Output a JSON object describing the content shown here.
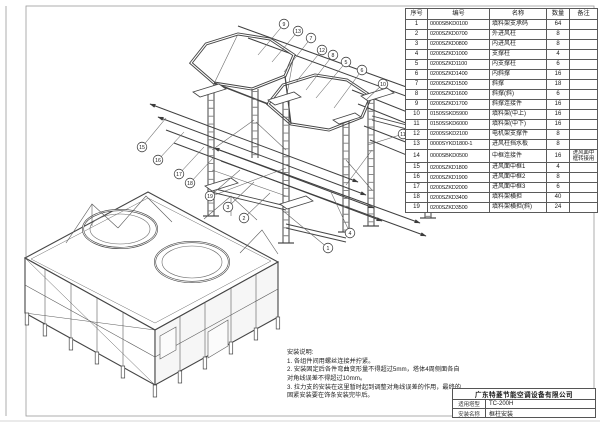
{
  "colors": {
    "line": "#454545",
    "paper": "#ffffff",
    "border": "#8a8a8a"
  },
  "parts_table": {
    "headers": [
      "序号",
      "编号",
      "名称",
      "数量",
      "备注"
    ],
    "rows": [
      [
        "1",
        "0000SBKD0100",
        "填料架支承码",
        "64",
        ""
      ],
      [
        "2",
        "0200SZKD0700",
        "外进风柱",
        "8",
        ""
      ],
      [
        "3",
        "0200SZKD0800",
        "内进风柱",
        "8",
        ""
      ],
      [
        "4",
        "0200SZKD1000",
        "支撑柱",
        "4",
        ""
      ],
      [
        "5",
        "0200SZKD1100",
        "内支撑柱",
        "6",
        ""
      ],
      [
        "6",
        "0200SZKD1400",
        "内斜撑",
        "16",
        ""
      ],
      [
        "7",
        "0200SZKD1500",
        "斜撑",
        "18",
        ""
      ],
      [
        "8",
        "0200SZKD1600",
        "斜撑(斜)",
        "6",
        ""
      ],
      [
        "9",
        "0200SZKD1700",
        "斜撑连接件",
        "16",
        ""
      ],
      [
        "10",
        "0150SSKD5900",
        "填料架(中上)",
        "16",
        ""
      ],
      [
        "11",
        "0150SSKD6000",
        "填料架(中下)",
        "16",
        ""
      ],
      [
        "12",
        "0200SSKD2100",
        "电机架支撑件",
        "8",
        ""
      ],
      [
        "13",
        "0000SYKD1800-1",
        "进风柱挡水板",
        "8",
        ""
      ],
      [
        "14",
        "0000SBKD0500",
        "中框连接件",
        "16",
        "进风面中框转接用"
      ],
      [
        "15",
        "0200SZKD1800",
        "进风面中框1",
        "4",
        ""
      ],
      [
        "16",
        "0200SZKD1900",
        "进风面中框2",
        "8",
        ""
      ],
      [
        "17",
        "0200SZKD2000",
        "进风面中框3",
        "6",
        ""
      ],
      [
        "18",
        "0200SZKD3400",
        "填料架横担",
        "40",
        ""
      ],
      [
        "19",
        "0200SZKD3500",
        "填料架横担(斜)",
        "24",
        ""
      ]
    ]
  },
  "notes": {
    "title": "安装说明:",
    "items": [
      "1. 各组件间用螺丝连接并拧紧。",
      "2. 安装固定后各件弯曲变形量不得超过5mm，塔体4周侧面各自对角线误差不得超过10mm。",
      "3. 拉力支的安装在这里暂时起到调整对角线误差的作用，最终的固紧安装要在饰条安装完毕后。"
    ]
  },
  "title_block": {
    "company": "广东特菱节能空调设备有限公司",
    "rows": [
      {
        "label": "适用塔型",
        "value": "TC-200H"
      },
      {
        "label": "安装名称",
        "value": "框柱安装"
      }
    ]
  },
  "callouts": [
    {
      "n": "9",
      "x": 284,
      "y": 24,
      "tx": 258,
      "ty": 55
    },
    {
      "n": "13",
      "x": 298,
      "y": 31,
      "tx": 272,
      "ty": 62
    },
    {
      "n": "7",
      "x": 311,
      "y": 38,
      "tx": 284,
      "ty": 72
    },
    {
      "n": "12",
      "x": 322,
      "y": 50,
      "tx": 296,
      "ty": 82
    },
    {
      "n": "8",
      "x": 333,
      "y": 55,
      "tx": 306,
      "ty": 90
    },
    {
      "n": "5",
      "x": 346,
      "y": 62,
      "tx": 316,
      "ty": 98
    },
    {
      "n": "6",
      "x": 362,
      "y": 70,
      "tx": 334,
      "ty": 108
    },
    {
      "n": "10",
      "x": 383,
      "y": 84,
      "tx": 366,
      "ty": 100
    },
    {
      "n": "11",
      "x": 403,
      "y": 134,
      "tx": 368,
      "ty": 145
    },
    {
      "n": "15",
      "x": 142,
      "y": 147,
      "tx": 166,
      "ty": 118
    },
    {
      "n": "16",
      "x": 158,
      "y": 160,
      "tx": 184,
      "ty": 132
    },
    {
      "n": "17",
      "x": 179,
      "y": 174,
      "tx": 204,
      "ty": 147
    },
    {
      "n": "18",
      "x": 190,
      "y": 183,
      "tx": 214,
      "ty": 157
    },
    {
      "n": "19",
      "x": 210,
      "y": 196,
      "tx": 240,
      "ty": 170
    },
    {
      "n": "3",
      "x": 228,
      "y": 207,
      "tx": 254,
      "ty": 182
    },
    {
      "n": "2",
      "x": 244,
      "y": 218,
      "tx": 270,
      "ty": 193
    },
    {
      "n": "4",
      "x": 350,
      "y": 233,
      "tx": 330,
      "ty": 190
    },
    {
      "n": "1",
      "x": 328,
      "y": 248,
      "tx": 282,
      "ty": 210
    }
  ]
}
